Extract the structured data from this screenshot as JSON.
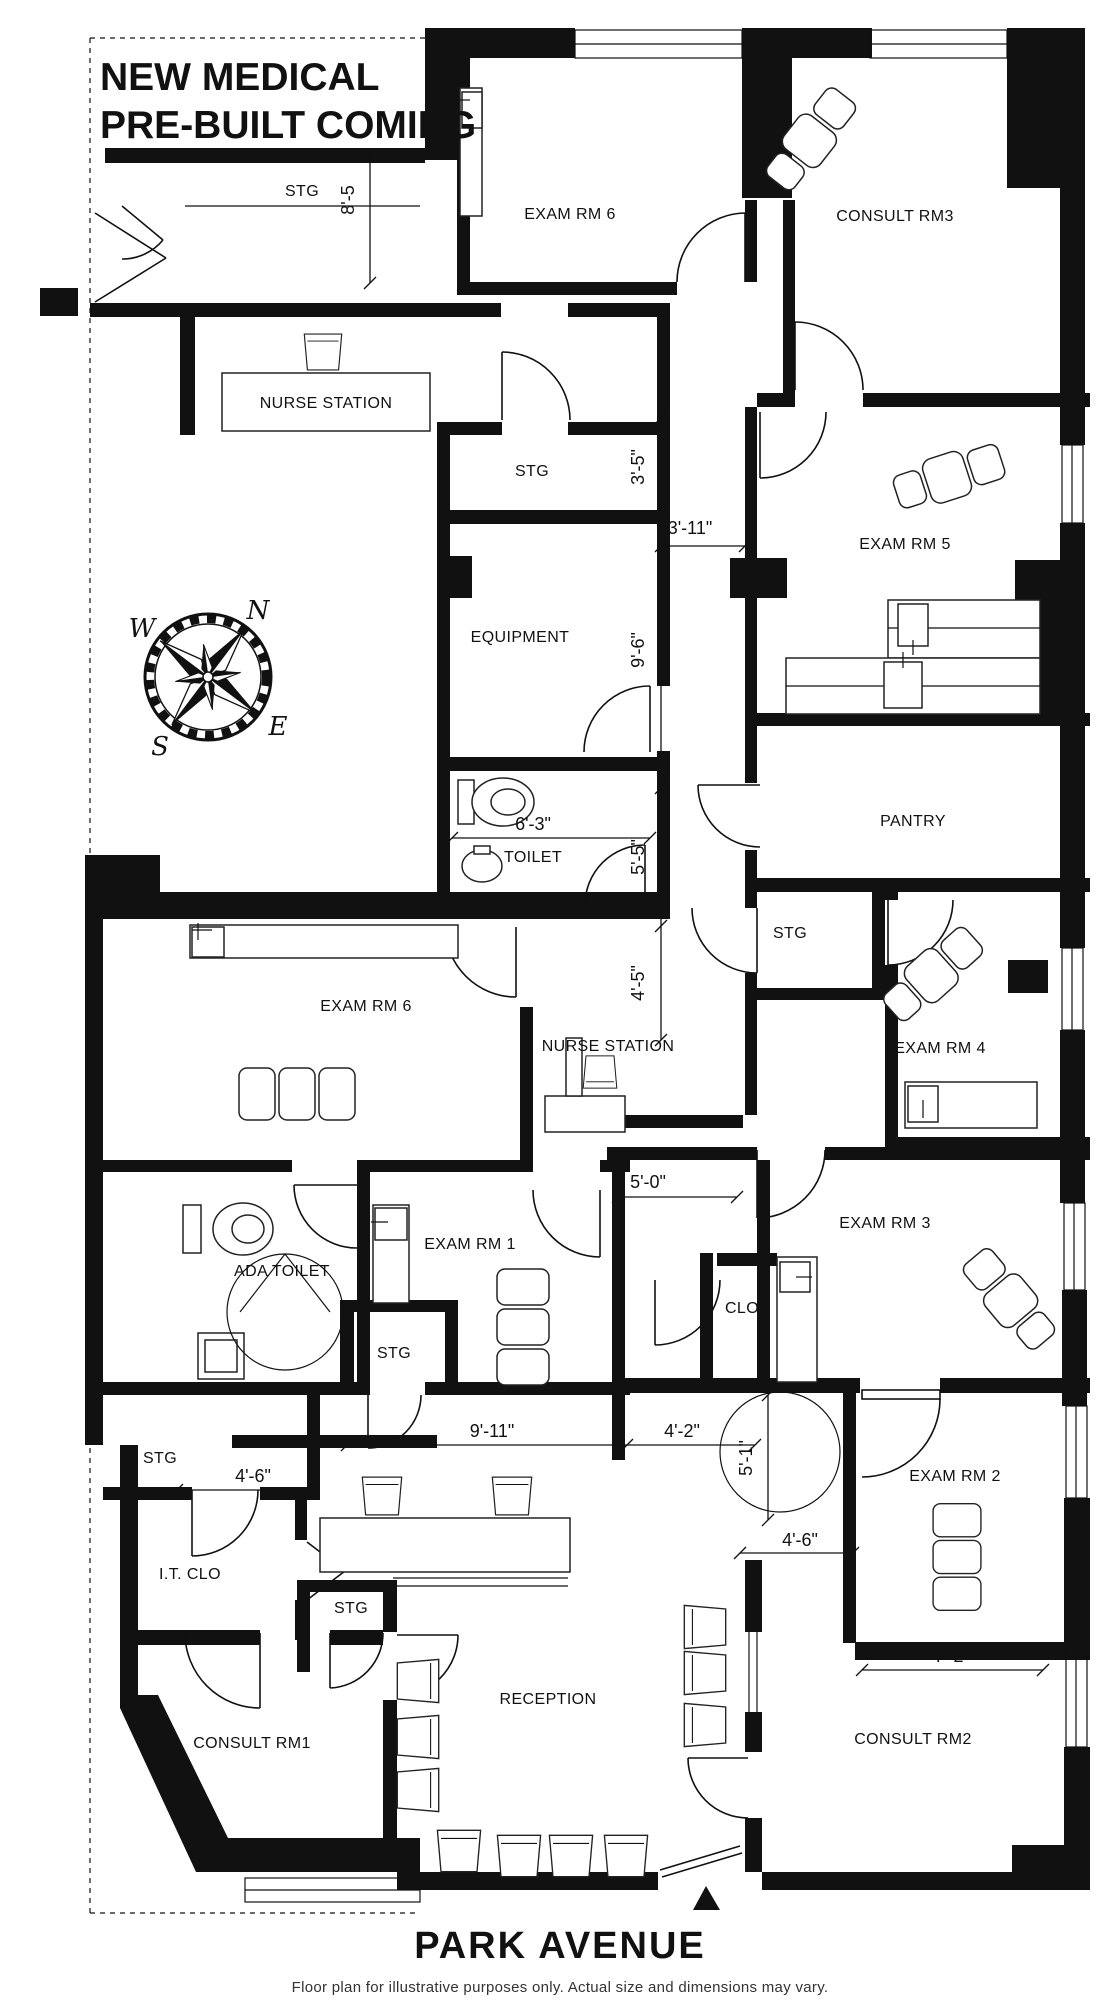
{
  "title": {
    "line1": "NEW MEDICAL",
    "line2": "PRE-BUILT COMING"
  },
  "footer": {
    "street": "PARK AVENUE",
    "disclaimer": "Floor plan for illustrative purposes only. Actual size and dimensions may vary."
  },
  "compass": {
    "n": "N",
    "w": "W",
    "e": "E",
    "s": "S"
  },
  "rooms": [
    {
      "name": "stg-top",
      "label": "STG"
    },
    {
      "name": "exam-rm-6-top",
      "label": "EXAM RM 6"
    },
    {
      "name": "consult-rm-3",
      "label": "CONSULT RM3"
    },
    {
      "name": "nurse-station-top",
      "label": "NURSE STATION"
    },
    {
      "name": "stg-mid",
      "label": "STG"
    },
    {
      "name": "exam-rm-5",
      "label": "EXAM RM 5"
    },
    {
      "name": "equipment",
      "label": "EQUIPMENT"
    },
    {
      "name": "toilet",
      "label": "TOILET"
    },
    {
      "name": "pantry",
      "label": "PANTRY"
    },
    {
      "name": "stg-right",
      "label": "STG"
    },
    {
      "name": "exam-rm-4",
      "label": "EXAM RM 4"
    },
    {
      "name": "exam-rm-6-lower",
      "label": "EXAM RM 6"
    },
    {
      "name": "nurse-station-lower",
      "label": "NURSE STATION"
    },
    {
      "name": "ada-toilet",
      "label": "ADA TOILET"
    },
    {
      "name": "exam-rm-1",
      "label": "EXAM RM 1"
    },
    {
      "name": "clo",
      "label": "CLO"
    },
    {
      "name": "exam-rm-3",
      "label": "EXAM RM 3"
    },
    {
      "name": "stg-exam1-closet",
      "label": "STG"
    },
    {
      "name": "stg-left",
      "label": "STG"
    },
    {
      "name": "it-clo",
      "label": "I.T.  CLO"
    },
    {
      "name": "exam-rm-2",
      "label": "EXAM RM 2"
    },
    {
      "name": "stg-reception",
      "label": "STG"
    },
    {
      "name": "reception",
      "label": "RECEPTION"
    },
    {
      "name": "consult-rm-1",
      "label": "CONSULT RM1"
    },
    {
      "name": "consult-rm-2",
      "label": "CONSULT RM2"
    }
  ],
  "dimensions": [
    {
      "name": "dim-8-5",
      "label": "8'-5"
    },
    {
      "name": "dim-3-5",
      "label": "3'-5\""
    },
    {
      "name": "dim-3-11",
      "label": "3'-11\""
    },
    {
      "name": "dim-9-6",
      "label": "9'-6\""
    },
    {
      "name": "dim-6-3",
      "label": "6'-3\""
    },
    {
      "name": "dim-5-5",
      "label": "5'-5\""
    },
    {
      "name": "dim-4-5",
      "label": "4'-5\""
    },
    {
      "name": "dim-5-0",
      "label": "5'-0\""
    },
    {
      "name": "dim-9-11",
      "label": "9'-11\""
    },
    {
      "name": "dim-4-2",
      "label": "4'-2\""
    },
    {
      "name": "dim-5-1",
      "label": "5'-1\""
    },
    {
      "name": "dim-4-6-left",
      "label": "4'-6\""
    },
    {
      "name": "dim-4-6-right",
      "label": "4'-6\""
    },
    {
      "name": "dim-7-2",
      "label": "7'-2\""
    }
  ]
}
